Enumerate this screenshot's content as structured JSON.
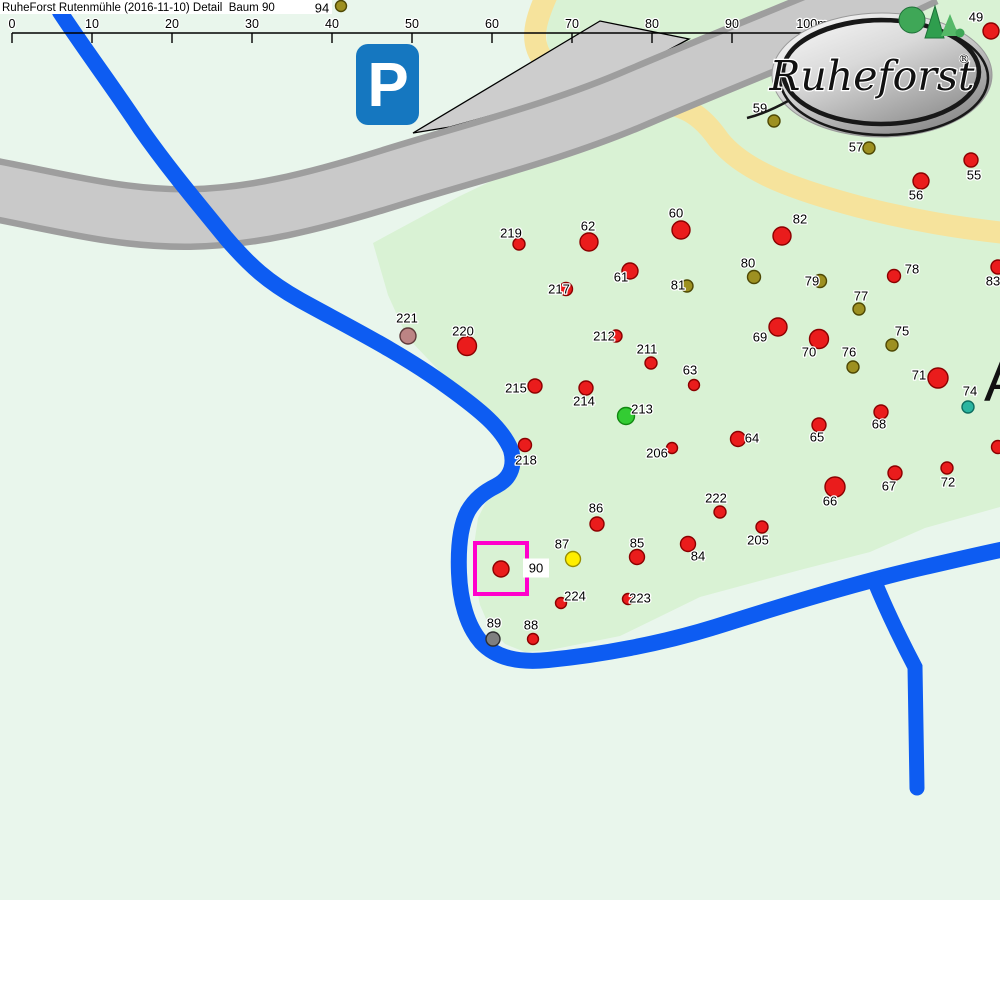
{
  "title": "RuheForst Rutenmühle (2016-11-10) Detail  Baum 90",
  "scale_bar": {
    "labels": [
      "0",
      "10",
      "20",
      "30",
      "40",
      "50",
      "60",
      "70",
      "80",
      "90",
      "100m"
    ],
    "origin_x": 12,
    "spacing_px": 80,
    "line_y": 33
  },
  "overlay_labels": {
    "area": "A"
  },
  "parking_sign": {
    "glyph": "P"
  },
  "logo": {
    "brand": "Ruheforst",
    "registered": "®"
  },
  "selected_tree": {
    "id": "90"
  },
  "colors": {
    "background": "#e9f6ec",
    "forest": "#d9f2d4",
    "road_fill": "#c9c9c9",
    "road_edge": "#9e9e9e",
    "parking_fill": "#cdcdcd",
    "river": "#0d5cf2",
    "path_yellow": "#f6e39c",
    "selection": "#ff00cc",
    "parking_sign_blue": "#1577c0",
    "dot_palette": {
      "red": {
        "fill": "#ea1c1c",
        "stroke": "#8b0000"
      },
      "olive": {
        "fill": "#9d9021",
        "stroke": "#4e4804"
      },
      "mauve": {
        "fill": "#bc8484",
        "stroke": "#5e3a3a"
      },
      "green": {
        "fill": "#33cc33",
        "stroke": "#118811"
      },
      "teal": {
        "fill": "#2ab5a0",
        "stroke": "#0e6e60"
      },
      "yellow": {
        "fill": "#ffee00",
        "stroke": "#9a8f00"
      },
      "gray": {
        "fill": "#7f7f7f",
        "stroke": "#2e2e2e"
      }
    }
  },
  "trees": [
    {
      "id": "94",
      "x": 341,
      "y": 6,
      "r": 5.5,
      "c": "olive",
      "lx": 322,
      "ly": 8
    },
    {
      "id": "49",
      "x": 991,
      "y": 31,
      "r": 8,
      "c": "red",
      "lx": 976,
      "ly": 17
    },
    {
      "id": "59",
      "x": 774,
      "y": 121,
      "r": 6,
      "c": "olive",
      "lx": 760,
      "ly": 108
    },
    {
      "id": "57",
      "x": 869,
      "y": 148,
      "r": 6,
      "c": "olive",
      "lx": 856,
      "ly": 147
    },
    {
      "id": "55",
      "x": 971,
      "y": 160,
      "r": 7,
      "c": "red",
      "lx": 974,
      "ly": 175
    },
    {
      "id": "56",
      "x": 921,
      "y": 181,
      "r": 8,
      "c": "red",
      "lx": 916,
      "ly": 195
    },
    {
      "id": "82",
      "x": 782,
      "y": 236,
      "r": 9,
      "c": "red",
      "lx": 800,
      "ly": 219
    },
    {
      "id": "219",
      "x": 519,
      "y": 244,
      "r": 6,
      "c": "red",
      "lx": 511,
      "ly": 233
    },
    {
      "id": "62",
      "x": 589,
      "y": 242,
      "r": 9,
      "c": "red",
      "lx": 588,
      "ly": 226
    },
    {
      "id": "60",
      "x": 681,
      "y": 230,
      "r": 9,
      "c": "red",
      "lx": 676,
      "ly": 213
    },
    {
      "id": "61",
      "x": 630,
      "y": 271,
      "r": 8,
      "c": "red",
      "lx": 621,
      "ly": 277
    },
    {
      "id": "81",
      "x": 687,
      "y": 286,
      "r": 6,
      "c": "olive",
      "lx": 678,
      "ly": 285
    },
    {
      "id": "217",
      "x": 566,
      "y": 289,
      "r": 6.5,
      "c": "red",
      "lx": 559,
      "ly": 289
    },
    {
      "id": "80",
      "x": 754,
      "y": 277,
      "r": 6.5,
      "c": "olive",
      "lx": 748,
      "ly": 263
    },
    {
      "id": "79",
      "x": 820,
      "y": 281,
      "r": 6.5,
      "c": "olive",
      "lx": 812,
      "ly": 281
    },
    {
      "id": "78",
      "x": 894,
      "y": 276,
      "r": 6.5,
      "c": "red",
      "lx": 912,
      "ly": 269
    },
    {
      "id": "77",
      "x": 859,
      "y": 309,
      "r": 6,
      "c": "olive",
      "lx": 861,
      "ly": 296
    },
    {
      "id": "83",
      "x": 998,
      "y": 267,
      "r": 7,
      "c": "red",
      "lx": 993,
      "ly": 281
    },
    {
      "id": "221",
      "x": 408,
      "y": 336,
      "r": 8,
      "c": "mauve",
      "lx": 407,
      "ly": 318
    },
    {
      "id": "220",
      "x": 467,
      "y": 346,
      "r": 9.5,
      "c": "red",
      "lx": 463,
      "ly": 331
    },
    {
      "id": "69",
      "x": 778,
      "y": 327,
      "r": 9,
      "c": "red",
      "lx": 760,
      "ly": 337
    },
    {
      "id": "70",
      "x": 819,
      "y": 339,
      "r": 9.5,
      "c": "red",
      "lx": 809,
      "ly": 352
    },
    {
      "id": "75",
      "x": 892,
      "y": 345,
      "r": 6,
      "c": "olive",
      "lx": 902,
      "ly": 331
    },
    {
      "id": "76",
      "x": 853,
      "y": 367,
      "r": 6,
      "c": "olive",
      "lx": 849,
      "ly": 352
    },
    {
      "id": "212",
      "x": 616,
      "y": 336,
      "r": 6,
      "c": "red",
      "lx": 604,
      "ly": 336
    },
    {
      "id": "211",
      "x": 651,
      "y": 363,
      "r": 6,
      "c": "red",
      "lx": 647,
      "ly": 349
    },
    {
      "id": "71",
      "x": 938,
      "y": 378,
      "r": 10,
      "c": "red",
      "lx": 919,
      "ly": 375
    },
    {
      "id": "74",
      "x": 968,
      "y": 407,
      "r": 6,
      "c": "teal",
      "lx": 970,
      "ly": 391
    },
    {
      "id": "63",
      "x": 694,
      "y": 385,
      "r": 5.5,
      "c": "red",
      "lx": 690,
      "ly": 370
    },
    {
      "id": "215",
      "x": 535,
      "y": 386,
      "r": 7,
      "c": "red",
      "lx": 516,
      "ly": 388
    },
    {
      "id": "214",
      "x": 586,
      "y": 388,
      "r": 7,
      "c": "red",
      "lx": 584,
      "ly": 401
    },
    {
      "id": "213",
      "x": 626,
      "y": 416,
      "r": 8.5,
      "c": "green",
      "lx": 642,
      "ly": 409
    },
    {
      "id": "65",
      "x": 819,
      "y": 425,
      "r": 7,
      "c": "red",
      "lx": 817,
      "ly": 437
    },
    {
      "id": "68",
      "x": 881,
      "y": 412,
      "r": 7,
      "c": "red",
      "lx": 879,
      "ly": 424
    },
    {
      "id": "64",
      "x": 738,
      "y": 439,
      "r": 7.5,
      "c": "red",
      "lx": 752,
      "ly": 438
    },
    {
      "id": "206",
      "x": 672,
      "y": 448,
      "r": 5.5,
      "c": "red",
      "lx": 657,
      "ly": 453
    },
    {
      "id": "218",
      "x": 525,
      "y": 445,
      "r": 6.5,
      "c": "red",
      "lx": 526,
      "ly": 460
    },
    {
      "id": "66",
      "x": 835,
      "y": 487,
      "r": 10,
      "c": "red",
      "lx": 830,
      "ly": 501
    },
    {
      "id": "67",
      "x": 895,
      "y": 473,
      "r": 7,
      "c": "red",
      "lx": 889,
      "ly": 486
    },
    {
      "id": "72",
      "x": 947,
      "y": 468,
      "r": 6,
      "c": "red",
      "lx": 948,
      "ly": 482
    },
    {
      "id": "",
      "x": 998,
      "y": 447,
      "r": 6.5,
      "c": "red",
      "lx": 0,
      "ly": 0
    },
    {
      "id": "86",
      "x": 597,
      "y": 524,
      "r": 7,
      "c": "red",
      "lx": 596,
      "ly": 508
    },
    {
      "id": "222",
      "x": 720,
      "y": 512,
      "r": 6,
      "c": "red",
      "lx": 716,
      "ly": 498
    },
    {
      "id": "205",
      "x": 762,
      "y": 527,
      "r": 6,
      "c": "red",
      "lx": 758,
      "ly": 540
    },
    {
      "id": "87",
      "x": 573,
      "y": 559,
      "r": 7.5,
      "c": "yellow",
      "lx": 562,
      "ly": 544
    },
    {
      "id": "85",
      "x": 637,
      "y": 557,
      "r": 7.5,
      "c": "red",
      "lx": 637,
      "ly": 543
    },
    {
      "id": "84",
      "x": 688,
      "y": 544,
      "r": 7.5,
      "c": "red",
      "lx": 698,
      "ly": 556
    },
    {
      "id": "90",
      "x": 501,
      "y": 569,
      "r": 8,
      "c": "red",
      "lx": 536,
      "ly": 568,
      "chip": true,
      "selected": true
    },
    {
      "id": "224",
      "x": 561,
      "y": 603,
      "r": 5.5,
      "c": "red",
      "lx": 575,
      "ly": 596
    },
    {
      "id": "223",
      "x": 628,
      "y": 599,
      "r": 5.5,
      "c": "red",
      "lx": 640,
      "ly": 598
    },
    {
      "id": "89",
      "x": 493,
      "y": 639,
      "r": 7,
      "c": "gray",
      "lx": 494,
      "ly": 623
    },
    {
      "id": "88",
      "x": 533,
      "y": 639,
      "r": 5.5,
      "c": "red",
      "lx": 531,
      "ly": 625
    }
  ],
  "selection_box": {
    "x": 475,
    "y": 543,
    "w": 52,
    "h": 51
  }
}
